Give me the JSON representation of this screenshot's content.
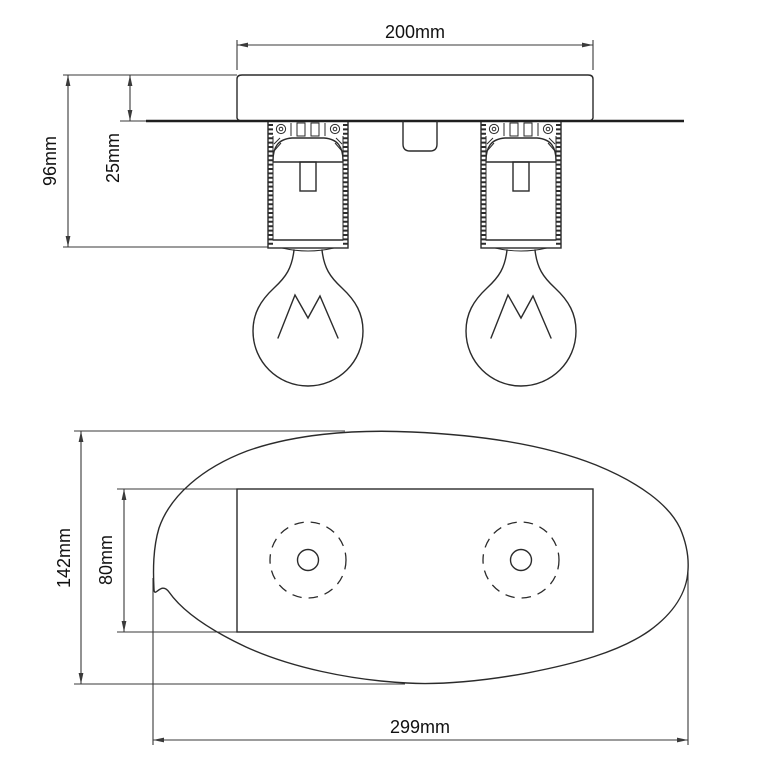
{
  "page": {
    "title": "Two-lamp ceiling light technical drawing",
    "background_color": "#ffffff",
    "line_color": "#2b2b2b",
    "dimension_line_color": "#3a3a3a",
    "text_color": "#111111"
  },
  "views": {
    "front": {
      "name": "Front elevation (ceiling mounted, two bulbs)",
      "dimensions": {
        "canopy_width": {
          "label": "200mm",
          "value_mm": 200
        },
        "overall_height": {
          "label": "96mm",
          "value_mm": 96
        },
        "canopy_depth": {
          "label": "25mm",
          "value_mm": 25
        }
      }
    },
    "plan": {
      "name": "Plan view (oval base with two lamp positions)",
      "dimensions": {
        "overall_length": {
          "label": "299mm",
          "value_mm": 299
        },
        "overall_width": {
          "label": "142mm",
          "value_mm": 142
        },
        "backplate_width": {
          "label": "80mm",
          "value_mm": 80
        }
      }
    }
  }
}
